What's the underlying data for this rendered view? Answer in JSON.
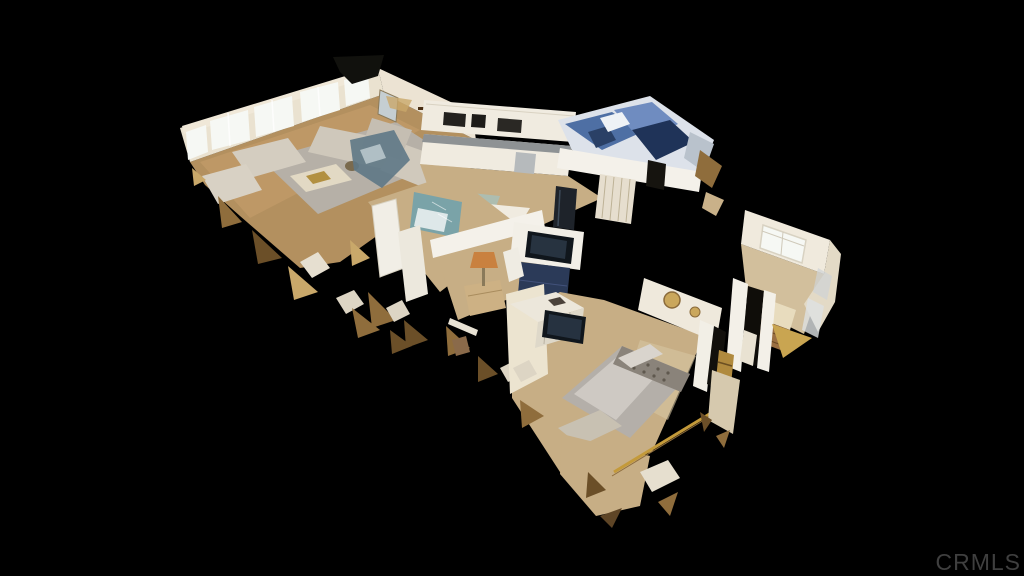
{
  "watermark": {
    "text": "CRMLS"
  },
  "image": {
    "type": "3d-dollhouse-cutaway",
    "description": "Aerial 3D dollhouse scan of a single-story home interior on a black background",
    "rooms": [
      {
        "name": "living-room",
        "features": [
          "window-wall-with-sheer-curtains",
          "gray-sectional-sofas",
          "coffee-table",
          "wall-mirror",
          "wall-cross",
          "area-rug"
        ]
      },
      {
        "name": "kitchen",
        "features": [
          "white-cabinets",
          "gray-countertop",
          "stainless-dishwasher",
          "black-refrigerator"
        ]
      },
      {
        "name": "blue-bedroom",
        "features": [
          "blue-and-navy-bedding",
          "striped-curtain",
          "white-partition-wall"
        ]
      },
      {
        "name": "hallway-bathroom",
        "features": [
          "teal-walls",
          "white-doors",
          "bathtub"
        ]
      },
      {
        "name": "den",
        "features": [
          "wall-mounted-tv",
          "navy-media-cabinet",
          "amber-table-lamp",
          "tan-chest"
        ]
      },
      {
        "name": "master-bedroom",
        "features": [
          "gray-upholstered-bed",
          "tufted-headboard",
          "cubby-dresser-with-tv",
          "foot-bench",
          "gold-mirror-wall"
        ]
      },
      {
        "name": "right-wing-room",
        "features": [
          "window",
          "wood-cabinet",
          "white-doorway"
        ]
      }
    ],
    "artifacts": [
      "ragged-scan-mesh-edges",
      "gold-torn-fragments"
    ]
  },
  "colors": {
    "background": "#000000",
    "watermark": "#3f3f3f",
    "wall_cream": "#eae2d0",
    "wall_white": "#f4f1ea",
    "window_bright": "#f6f8f4",
    "floor_wood": "#b3905f",
    "floor_tan": "#c7ae85",
    "rug_gray": "#b6b0a7",
    "sofa_beige": "#cfc8bb",
    "bed_gray": "#b4afa9",
    "headboard_gray": "#8a837a",
    "blue_accent": "#4e6fa4",
    "navy_dark": "#1f3358",
    "bath_teal": "#7aa3a8",
    "cabinet_white": "#f0ebe0",
    "counter_gray": "#8e9294",
    "tv_dark": "#10161c",
    "media_navy": "#2b3a58",
    "lamp_amber": "#c9813f",
    "wood_brown": "#9a6f42",
    "gold_trim": "#8f6d3c",
    "gold_light": "#c9a86a"
  }
}
